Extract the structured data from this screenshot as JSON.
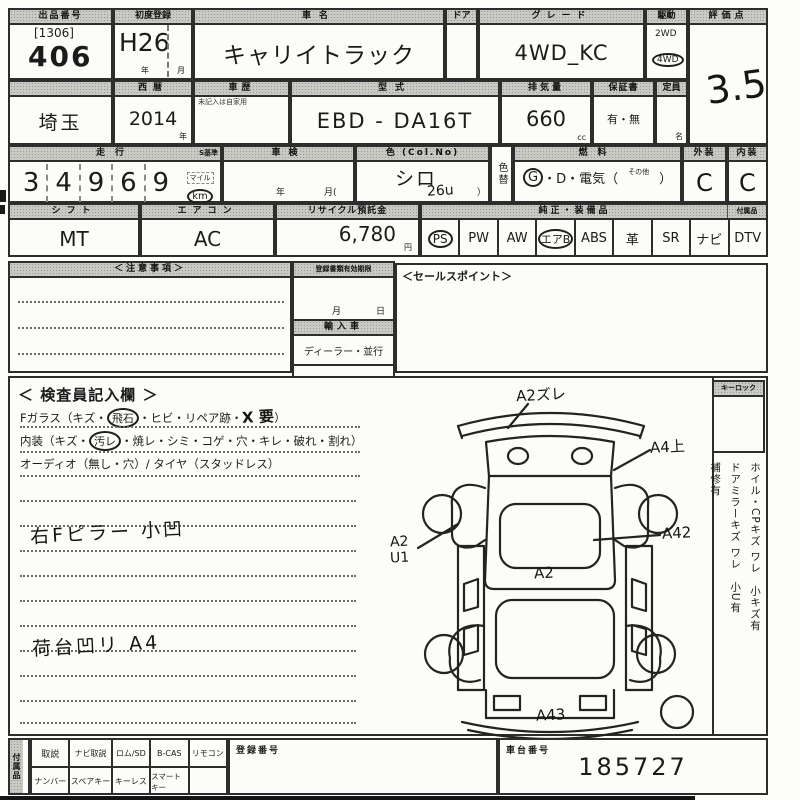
{
  "sheet": {
    "row1": {
      "auction": {
        "label": "出品番号",
        "code": "[1306]",
        "number": "406"
      },
      "first_reg": {
        "label": "初度登録",
        "value": "H26",
        "year": "年",
        "month": "月"
      },
      "car_name": {
        "label": "車名",
        "value": "キャリイトラック"
      },
      "door": {
        "label": "ドア"
      },
      "grade": {
        "label": "グレード",
        "value": "4WD_KC"
      },
      "drive": {
        "label": "駆動",
        "opt1": "2WD",
        "opt2": "4WD"
      },
      "score": {
        "label": "評価点",
        "value": "3.5"
      }
    },
    "row2": {
      "prefecture": "埼玉",
      "year": {
        "label": "西暦",
        "value": "2014",
        "unit": "年"
      },
      "history": {
        "label": "車歴",
        "note": "未記入は自家用"
      },
      "model": {
        "label": "型式",
        "value": "EBD - DA16T"
      },
      "displacement": {
        "label": "排気量",
        "value": "660",
        "unit": "cc"
      },
      "warranty": {
        "label": "保証書",
        "value": "有・無"
      },
      "capacity": {
        "label": "定員",
        "unit": "名"
      }
    },
    "row3": {
      "mileage": {
        "label": "走行",
        "s_label": "S基準",
        "digits": [
          "3",
          "4",
          "9",
          "6",
          "9"
        ],
        "unit_top": "マイル",
        "unit": "km"
      },
      "inspection": {
        "label": "車検",
        "year": "年",
        "month": "月("
      },
      "color": {
        "label": "色 (Col.No)",
        "value": "シロ",
        "code": "26u",
        "close": "）"
      },
      "color_change": {
        "label": "色替"
      },
      "fuel": {
        "label": "燃料",
        "g": "G",
        "rest": "・D・電気（",
        "other": "その他",
        "close": "）"
      },
      "exterior": {
        "label": "外装",
        "value": "C"
      },
      "interior": {
        "label": "内装",
        "value": "C"
      }
    },
    "row4": {
      "shift": {
        "label": "シフト",
        "value": "MT"
      },
      "aircon": {
        "label": "エアコン",
        "value": "AC"
      },
      "recycle": {
        "label": "リサイクル預託金",
        "value": "6,780",
        "unit": "円"
      },
      "equipment": {
        "label": "純正・装備品",
        "acc_label": "付属品",
        "items": [
          "PS",
          "PW",
          "AW",
          "エアB",
          "ABS",
          "革",
          "SR",
          "ナビ",
          "DTV"
        ]
      }
    },
    "mid": {
      "notes_label": "＜注意事項＞",
      "validity": {
        "label": "登録書類有効期限",
        "month": "月",
        "day": "日"
      },
      "import_label": "輸入車",
      "dealer": "ディーラー・並行",
      "handle": "左H ・ 右H",
      "sales_label": "＜セールスポイント＞"
    },
    "inspector": {
      "title": "＜ 検査員記入欄 ＞",
      "glass_pre": "Fガラス（キズ・",
      "glass_circled": "飛石",
      "glass_mid": "・ヒビ・リペア跡・",
      "glass_hand": "X 要",
      "glass_post": "）",
      "interior_pre": "内装（キズ・",
      "interior_circled": "汚レ",
      "interior_post": "・焼レ・シミ・コゲ・穴・キレ・破れ・割れ）",
      "audio_line": "オーディオ（無し・穴）/ タイヤ（スタッドレス）",
      "hand_note1": "右Fピラー 小凹",
      "hand_note2": "荷台凹リ A4"
    },
    "diagram": {
      "top": "A2ズレ",
      "right_top": "A4上",
      "right_mid": "A42",
      "left1": "A2",
      "left2": "U1",
      "center": "A2",
      "bottom": "A43"
    },
    "sidebar": {
      "key_lock": "キーロック",
      "note1": "ホイル・CPキズ ワレ　小キズ有",
      "note2": "ドアミラーキズ ワレ　小U有",
      "note3": "補修有"
    },
    "bottom": {
      "vertical_label": "付属品",
      "row1": [
        "取説",
        "ナビ取説",
        "ロム/SD",
        "B-CAS",
        "リモコン"
      ],
      "row2": [
        "ナンバー",
        "スペアキー",
        "キーレス",
        "スマートキー"
      ],
      "reg_label": "登録番号",
      "chassis_label": "車台番号",
      "chassis_value": "185727"
    }
  }
}
